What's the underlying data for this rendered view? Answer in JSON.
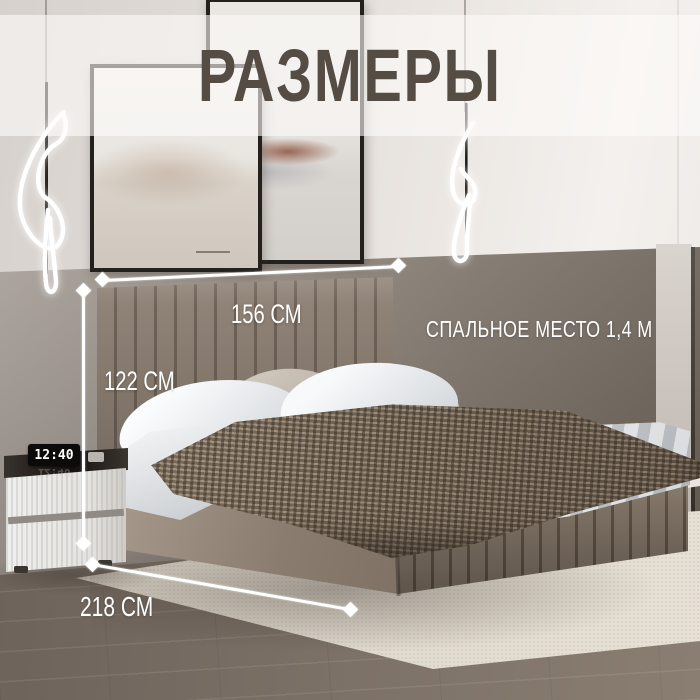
{
  "title": "РАЗМЕРЫ",
  "dimensions": {
    "headboard_width": "156 СМ",
    "headboard_height": "122 СМ",
    "bed_length": "218 СМ",
    "sleeping_area": "СПАЛЬНОЕ МЕСТО 1,4 М"
  },
  "nightstand": {
    "clock_time": "12:40"
  },
  "palette": {
    "title_color": "#554c44",
    "upper_wall": "#e6e1dc",
    "accent_wall_left": "#aba39c",
    "accent_wall_right": "#6b6158",
    "headboard": "#8b7e72",
    "bed_base": "#8a7d70",
    "blanket": "#7c6e5d",
    "rug": "#ded7cc",
    "floor": "#7d7268",
    "annotation_color": "#ffffff"
  }
}
